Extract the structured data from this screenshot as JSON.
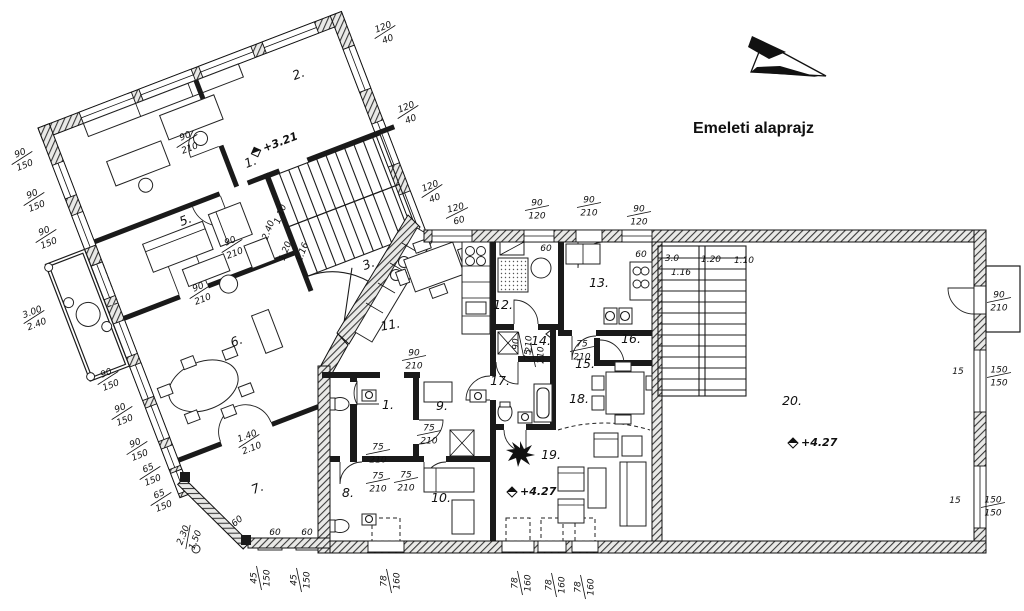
{
  "title": "Emeleti alaprajz",
  "colors": {
    "ink": "#1a1a1a",
    "paper": "#ffffff",
    "wall_hatch": "#3a3a3a"
  },
  "icons": {
    "north_arrow": "north-arrow",
    "level_marker": "level-diamond"
  },
  "rooms": [
    {
      "label": "1.",
      "x": 252,
      "y": 166,
      "r": -21
    },
    {
      "label": "2.",
      "x": 300,
      "y": 78,
      "r": -21
    },
    {
      "label": "3.",
      "x": 370,
      "y": 268,
      "r": -21
    },
    {
      "label": "5.",
      "x": 187,
      "y": 224,
      "r": -21
    },
    {
      "label": "6.",
      "x": 238,
      "y": 345,
      "r": -21
    },
    {
      "label": "7.",
      "x": 259,
      "y": 492,
      "r": -21
    },
    {
      "label": "1.",
      "x": 388,
      "y": 409,
      "r": 0
    },
    {
      "label": "8.",
      "x": 348,
      "y": 497,
      "r": 0
    },
    {
      "label": "9.",
      "x": 442,
      "y": 410,
      "r": 0
    },
    {
      "label": "10.",
      "x": 441,
      "y": 502,
      "r": 0
    },
    {
      "label": "11.",
      "x": 391,
      "y": 329,
      "r": -10
    },
    {
      "label": "12.",
      "x": 503,
      "y": 309,
      "r": 0
    },
    {
      "label": "13.",
      "x": 599,
      "y": 287,
      "r": 0
    },
    {
      "label": "14.",
      "x": 541,
      "y": 345,
      "r": 0
    },
    {
      "label": "15.",
      "x": 585,
      "y": 368,
      "r": 0
    },
    {
      "label": "16.",
      "x": 631,
      "y": 343,
      "r": 0
    },
    {
      "label": "17.",
      "x": 500,
      "y": 385,
      "r": 0
    },
    {
      "label": "18.",
      "x": 579,
      "y": 403,
      "r": 0
    },
    {
      "label": "19.",
      "x": 551,
      "y": 459,
      "r": 0
    },
    {
      "label": "20.",
      "x": 792,
      "y": 405,
      "r": 0
    }
  ],
  "elevations": [
    {
      "label": "+3.21",
      "x": 256,
      "y": 152,
      "r": -21
    },
    {
      "label": "+4.27",
      "x": 512,
      "y": 492,
      "r": 0
    },
    {
      "label": "+4.27",
      "x": 793,
      "y": 443,
      "r": 0
    }
  ],
  "dimensions": [
    {
      "a": "90",
      "b": "150",
      "x": 22,
      "y": 158,
      "r": -21
    },
    {
      "a": "90",
      "b": "150",
      "x": 34,
      "y": 199,
      "r": -21
    },
    {
      "a": "90",
      "b": "150",
      "x": 46,
      "y": 236,
      "r": -21
    },
    {
      "a": "3.00",
      "b": "2.40",
      "x": 34,
      "y": 317,
      "r": -21
    },
    {
      "a": "90",
      "b": "150",
      "x": 108,
      "y": 378,
      "r": -21
    },
    {
      "a": "90",
      "b": "150",
      "x": 122,
      "y": 413,
      "r": -21
    },
    {
      "a": "90",
      "b": "150",
      "x": 137,
      "y": 448,
      "r": -21
    },
    {
      "a": "65",
      "b": "150",
      "x": 150,
      "y": 473,
      "r": -21
    },
    {
      "a": "65",
      "b": "150",
      "x": 161,
      "y": 499,
      "r": -21
    },
    {
      "a": "2.30",
      "b": "1.50",
      "x": 188,
      "y": 537,
      "r": -68
    },
    {
      "a": "120",
      "b": "40",
      "x": 385,
      "y": 32,
      "r": -21
    },
    {
      "a": "120",
      "b": "40",
      "x": 408,
      "y": 112,
      "r": -21
    },
    {
      "a": "120",
      "b": "40",
      "x": 432,
      "y": 191,
      "r": -21
    },
    {
      "a": "120",
      "b": "60",
      "x": 457,
      "y": 213,
      "r": -15
    },
    {
      "a": "90",
      "b": "120",
      "x": 537,
      "y": 208,
      "r": 0
    },
    {
      "a": "90",
      "b": "210",
      "x": 589,
      "y": 205,
      "r": 0
    },
    {
      "a": "90",
      "b": "120",
      "x": 639,
      "y": 214,
      "r": 0
    },
    {
      "a": "90",
      "b": "210",
      "x": 187,
      "y": 141,
      "r": -21
    },
    {
      "a": "90",
      "b": "210",
      "x": 200,
      "y": 292,
      "r": -21
    },
    {
      "a": "90",
      "b": "210",
      "x": 232,
      "y": 246,
      "r": -21
    },
    {
      "a": "1.40",
      "b": "2.10",
      "x": 249,
      "y": 441,
      "r": -21
    },
    {
      "a": "1.10",
      "x": 280,
      "y": 214,
      "r": -69
    },
    {
      "a": "2.40",
      "x": 268,
      "y": 230,
      "r": -69
    },
    {
      "a": "1.20",
      "x": 285,
      "y": 251,
      "r": -69
    },
    {
      "a": "1.16",
      "x": 302,
      "y": 252,
      "r": -69
    },
    {
      "a": "90",
      "b": "210",
      "x": 414,
      "y": 358,
      "r": 0
    },
    {
      "a": "75",
      "b": "210",
      "x": 378,
      "y": 452,
      "r": 0
    },
    {
      "a": "75",
      "b": "210",
      "x": 378,
      "y": 481,
      "r": 0
    },
    {
      "a": "75",
      "b": "210",
      "x": 406,
      "y": 480,
      "r": 0
    },
    {
      "a": "75",
      "b": "210",
      "x": 429,
      "y": 433,
      "r": 0
    },
    {
      "a": "90",
      "b": "210",
      "x": 521,
      "y": 344,
      "r": -90
    },
    {
      "a": "75",
      "b": "210",
      "x": 533,
      "y": 355,
      "r": -90
    },
    {
      "a": "75",
      "b": "210",
      "x": 582,
      "y": 349,
      "r": 0
    },
    {
      "a": "60",
      "x": 546,
      "y": 248,
      "r": 0
    },
    {
      "a": "60",
      "x": 641,
      "y": 254,
      "r": 0
    },
    {
      "a": "60",
      "x": 237,
      "y": 521,
      "r": -40
    },
    {
      "a": "60",
      "x": 275,
      "y": 532,
      "r": 0
    },
    {
      "a": "60",
      "x": 307,
      "y": 532,
      "r": 0
    },
    {
      "a": "3.0",
      "x": 672,
      "y": 258,
      "r": 0
    },
    {
      "a": "1.20",
      "x": 711,
      "y": 259,
      "r": 0
    },
    {
      "a": "1.10",
      "x": 744,
      "y": 260,
      "r": 0
    },
    {
      "a": "1.16",
      "x": 681,
      "y": 272,
      "r": 0
    },
    {
      "a": "90",
      "b": "210",
      "x": 999,
      "y": 300,
      "r": 0
    },
    {
      "a": "150",
      "b": "150",
      "x": 999,
      "y": 375,
      "r": 0
    },
    {
      "a": "15",
      "x": 958,
      "y": 371,
      "r": 0
    },
    {
      "a": "150",
      "b": "150",
      "x": 993,
      "y": 505,
      "r": 0
    },
    {
      "a": "15",
      "x": 955,
      "y": 500,
      "r": 0
    },
    {
      "a": "45",
      "b": "150",
      "x": 259,
      "y": 578,
      "r": -90
    },
    {
      "a": "45",
      "b": "150",
      "x": 299,
      "y": 580,
      "r": -90
    },
    {
      "a": "78",
      "b": "160",
      "x": 389,
      "y": 581,
      "r": -90
    },
    {
      "a": "78",
      "b": "160",
      "x": 520,
      "y": 583,
      "r": -90
    },
    {
      "a": "78",
      "b": "160",
      "x": 554,
      "y": 585,
      "r": -90
    },
    {
      "a": "78",
      "b": "160",
      "x": 583,
      "y": 587,
      "r": -90
    }
  ]
}
